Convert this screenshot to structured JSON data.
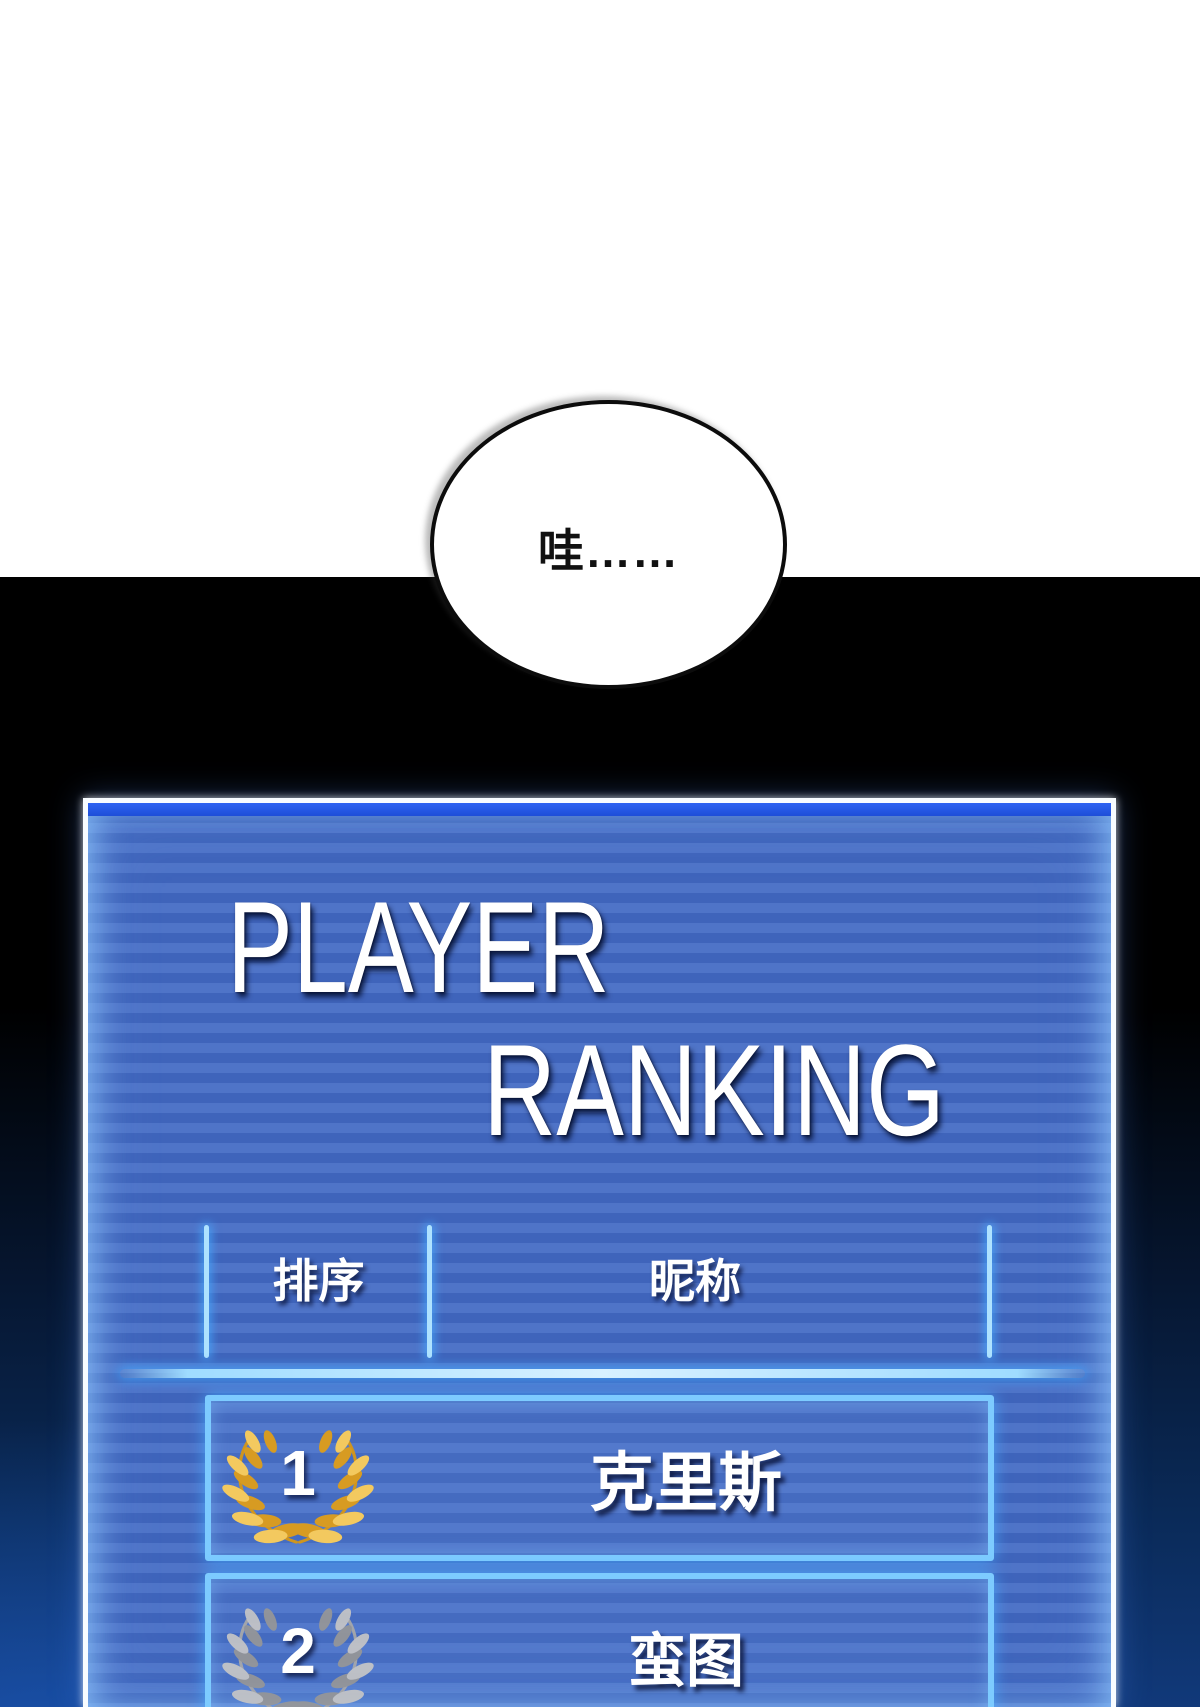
{
  "speech_bubble": {
    "text": "哇……"
  },
  "ranking_panel": {
    "title_line1": "PLAYER",
    "title_line2": "RANKING",
    "header": {
      "rank_column": "排序",
      "nickname_column": "昵称"
    },
    "rows": [
      {
        "rank": "1",
        "nickname": "克里斯",
        "wreath": "gold-laurel-wreath"
      },
      {
        "rank": "2",
        "nickname": "蛮图",
        "wreath": "silver-laurel-wreath"
      }
    ]
  },
  "colors": {
    "panel_stripe_light": "#4f74c8",
    "panel_stripe_dark": "#3f64bb",
    "panel_top_bar": "#2156e8",
    "neon_line": "#8fd4ff",
    "gold_light": "#f3c95f",
    "gold_dark": "#d79b22",
    "gold_stem": "#cf951f",
    "silver_light": "#c6c6c6",
    "silver_dark": "#979797",
    "silver_stem": "#a9a9a9",
    "background_bottom_glow": "#11397a"
  }
}
